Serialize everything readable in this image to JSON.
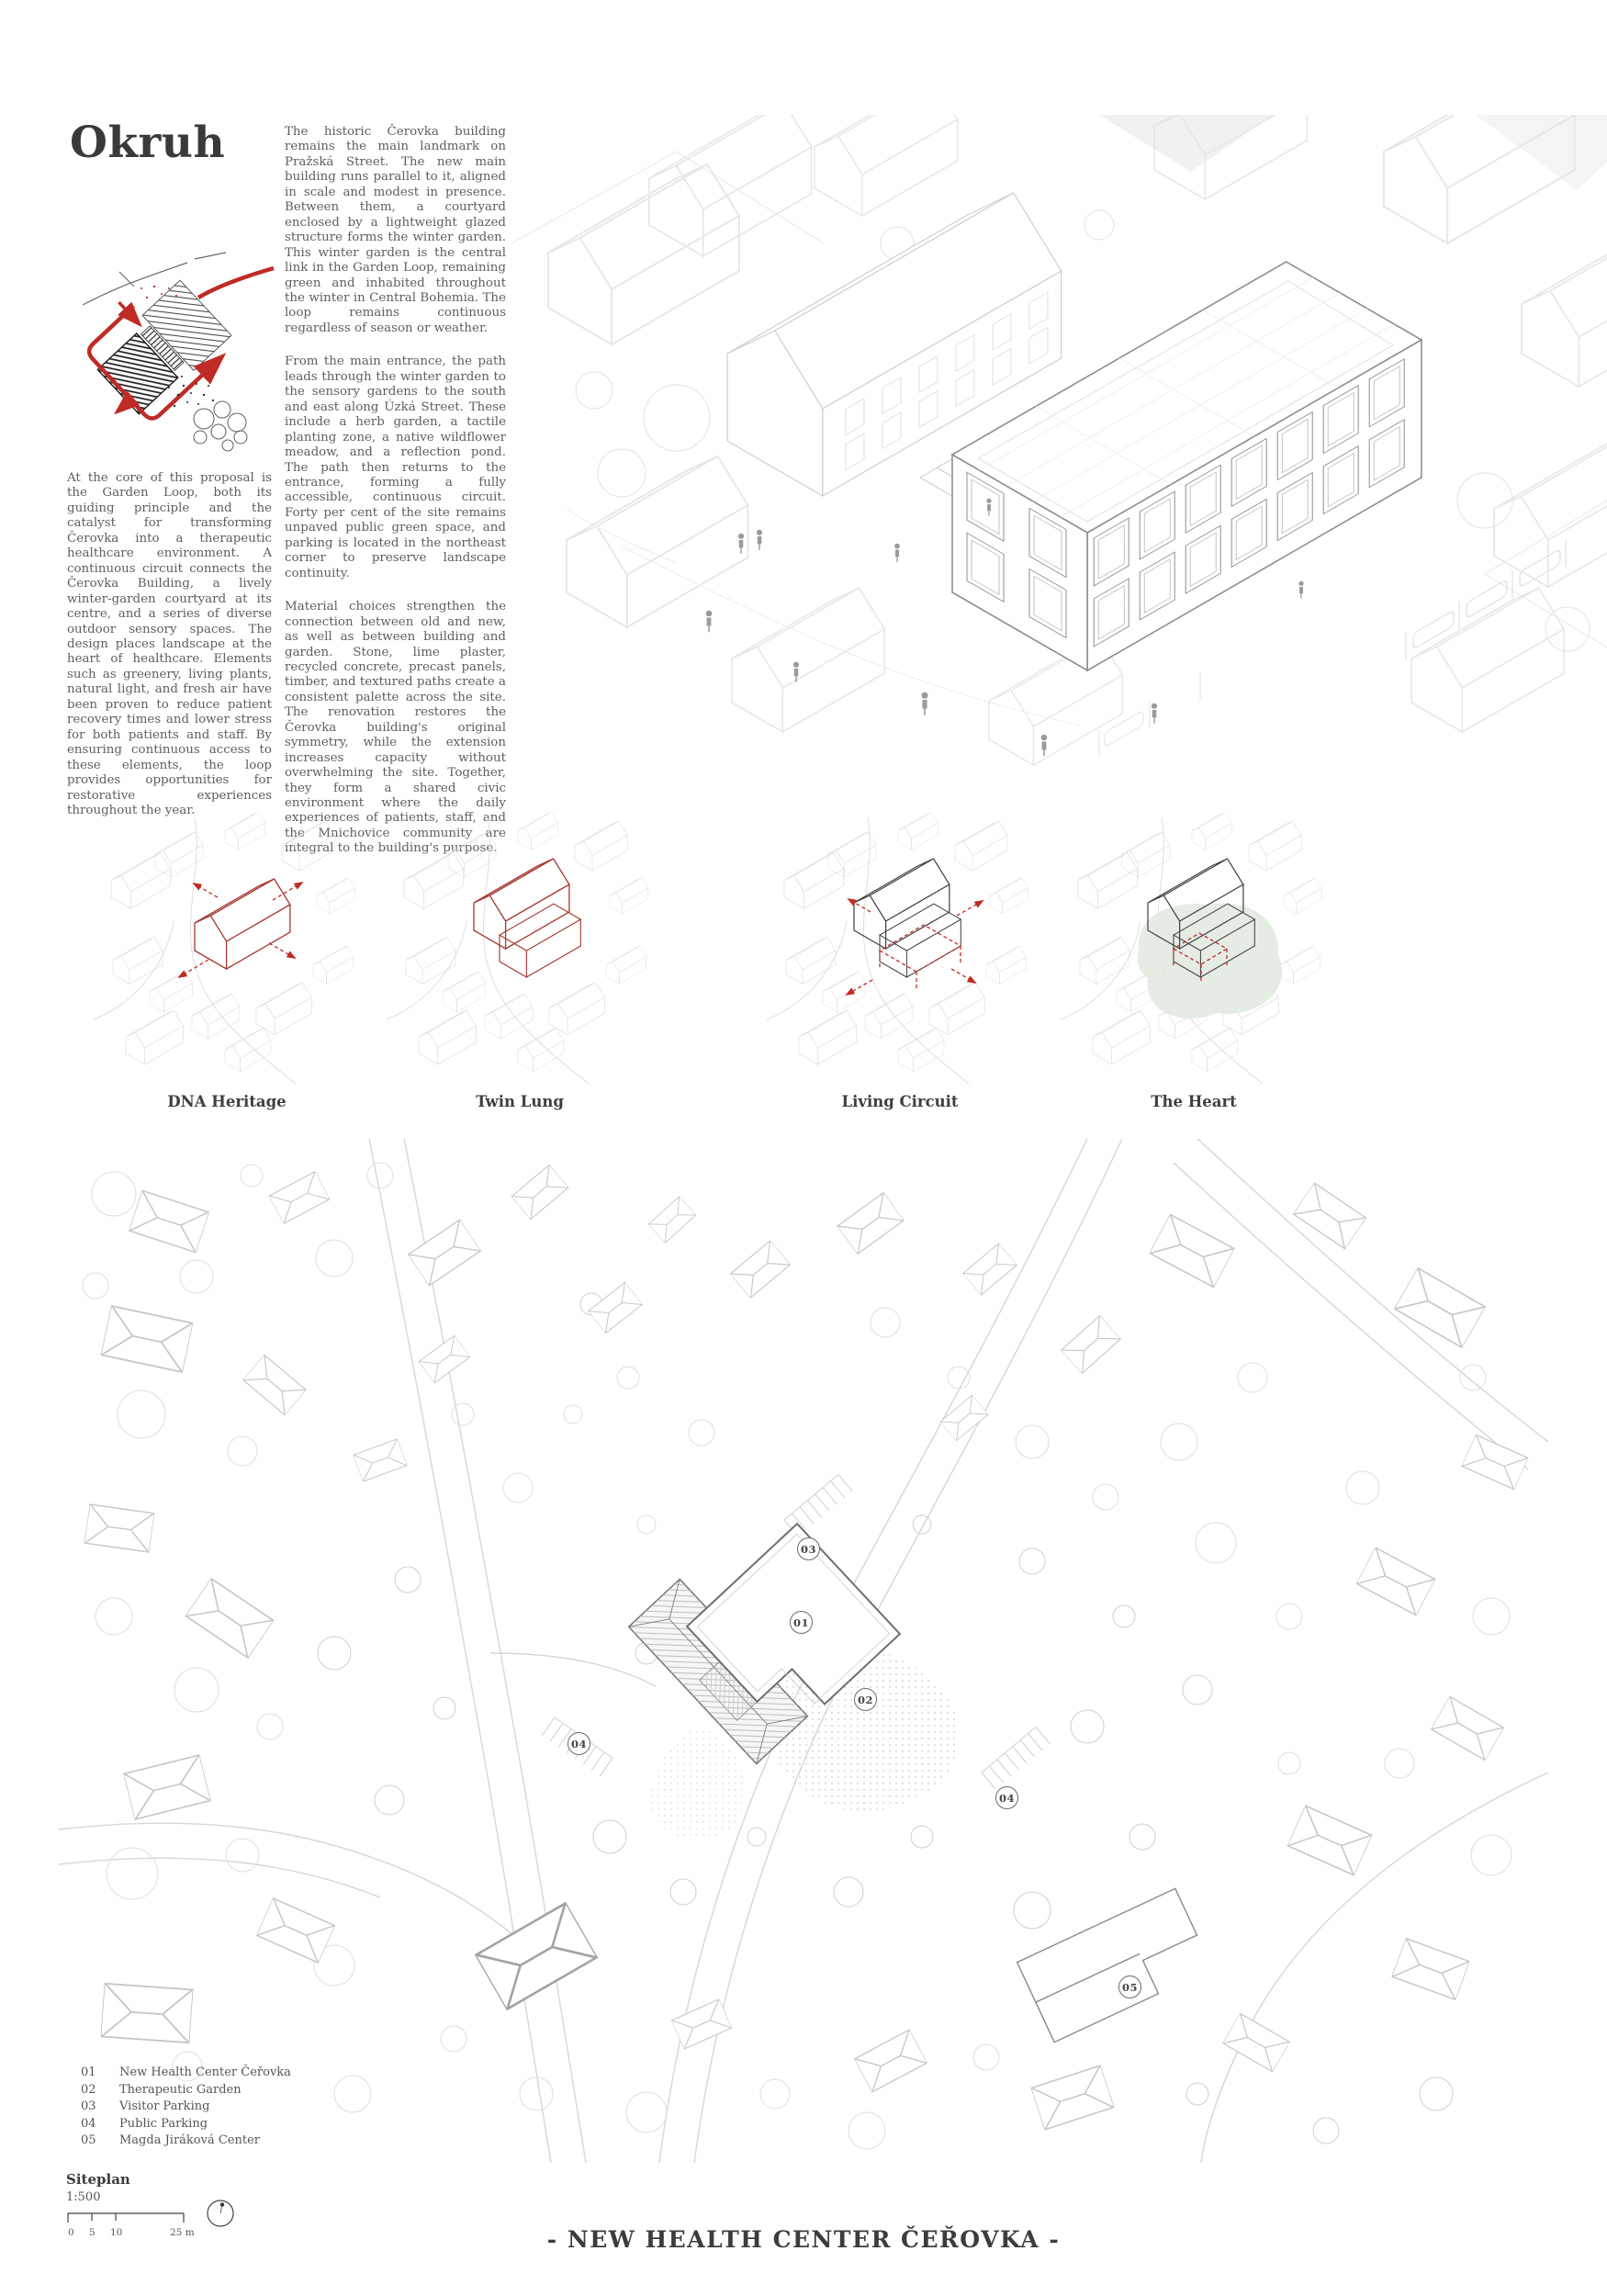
{
  "colors": {
    "accent_red": "#bf2b26",
    "diagram_red": "#a43832",
    "sage_green": "#dfe9df",
    "ink": "#3a3a3a",
    "body_text": "#5e5e5e"
  },
  "header": {
    "title": "Okruh",
    "intro": "At the core of this proposal is the Garden Loop, both its guiding principle and the catalyst for transforming Čerovka into a therapeutic healthcare environment. A continuous circuit connects the Čerovka Building, a lively winter-garden courtyard at its centre, and a series of diverse outdoor sensory spaces. The design places landscape at the heart of healthcare. Elements such as greenery, living plants, natural light, and fresh air have been proven to reduce patient recovery times and lower stress for both patients and staff. By ensuring continuous access to these elements, the loop provides opportunities for restorative experiences throughout the year.",
    "para1": "The historic Čerovka building remains the main landmark on Pražská Street. The new main building runs parallel to it, aligned in scale and modest in presence. Between them, a courtyard enclosed by a lightweight glazed structure forms the winter garden. This winter garden is the central link in the Garden Loop, remaining green and inhabited throughout the winter in Central Bohemia. The loop remains continuous regardless of season or weather.",
    "para2": "From the main entrance, the path leads through the winter garden to the sensory gardens to the south and east along Úzká Street. These include a herb garden, a tactile planting zone, a native wildflower meadow, and a reflection pond. The path then returns to the entrance, forming a fully accessible, continuous circuit. Forty per cent of the site remains unpaved public green space, and parking is located in the northeast corner to preserve landscape continuity.",
    "para3": "Material choices strengthen the connection between old and new, as well as between building and garden. Stone, lime plaster, recycled concrete, precast panels, timber, and textured paths create a consistent palette across the site. The renovation restores the Čerovka building's original symmetry, while the extension increases capacity without overwhelming the site. Together, they form a shared civic environment where the daily experiences of patients, staff, and the Mnichovice community are integral to the building's purpose."
  },
  "diagrams": [
    {
      "label": "DNA Heritage"
    },
    {
      "label": "Twin Lung"
    },
    {
      "label": "Living Circuit"
    },
    {
      "label": "The Heart"
    }
  ],
  "siteplan": {
    "markers": [
      {
        "label": "01"
      },
      {
        "label": "02"
      },
      {
        "label": "03"
      },
      {
        "label": "04"
      },
      {
        "label": "04"
      },
      {
        "label": "05"
      }
    ],
    "legend": [
      {
        "num": "01",
        "label": "New Health Center Čeřovka"
      },
      {
        "num": "02",
        "label": "Therapeutic Garden"
      },
      {
        "num": "03",
        "label": "Visitor Parking"
      },
      {
        "num": "04",
        "label": "Public Parking"
      },
      {
        "num": "05",
        "label": "Magda Jiráková Center"
      }
    ],
    "title": "Siteplan",
    "scale": "1:500",
    "ticks": {
      "t0": "0",
      "t1": "5",
      "t2": "10",
      "t3": "25 m"
    }
  },
  "footer": {
    "title": "- NEW HEALTH CENTER ČEŘOVKA -"
  }
}
